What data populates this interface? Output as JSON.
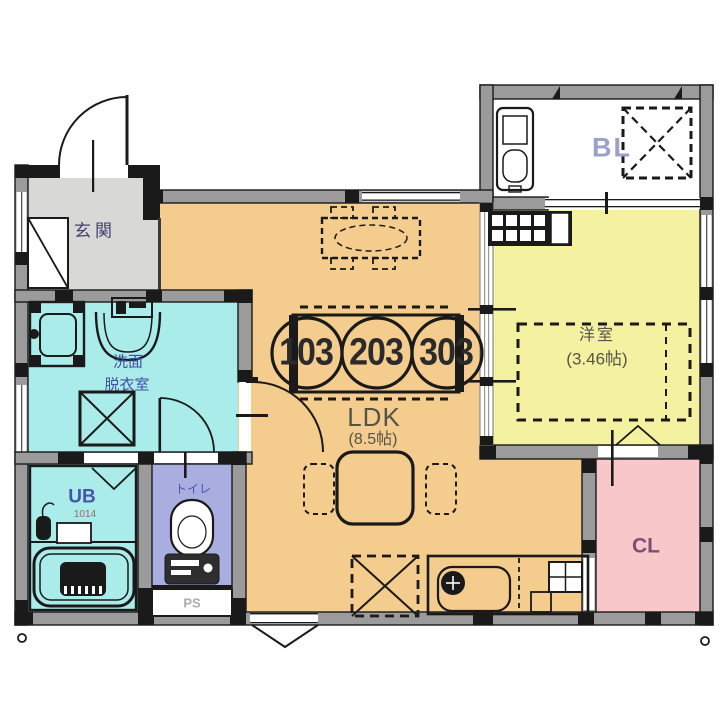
{
  "plan_title": "1LDK apartment floor plan",
  "unit_numbers": [
    "103",
    "203",
    "303"
  ],
  "rooms": {
    "entrance": {
      "label": "玄関"
    },
    "ldk": {
      "label": "LDK",
      "area": "(8.5帖)"
    },
    "western_room": {
      "label": "洋室",
      "area": "(3.46帖)"
    },
    "balcony": {
      "label": "BL"
    },
    "closet": {
      "label": "CL"
    },
    "washroom": {
      "line1": "洗面",
      "line2": "脱衣室"
    },
    "toilet": {
      "label": "トイレ"
    },
    "unit_bath": {
      "label": "UB",
      "size": "1014"
    },
    "pipe_space": {
      "label": "PS"
    }
  },
  "colors": {
    "ldk": "#F3CC8E",
    "western_room": "#F4F1A1",
    "wet_area_cyan": "#AAECE9",
    "toilet_lavender": "#A9ADE0",
    "closet_pink": "#F8C7CA",
    "entrance_gray": "#D8D8D6",
    "balcony_white": "#FFFFFF",
    "wall_fill": "#9B9B9B",
    "wall_line": "#1A1A1A",
    "label_blue": "#4050A0",
    "label_dark": "#55544A",
    "label_bl": "#98A2C8",
    "label_cl": "#7E4E78",
    "label_entrance": "#42426A",
    "label_ub_size": "#996A6A",
    "label_ps": "#A8ADB5",
    "unit_number": "#2B2B2B"
  },
  "icons": {
    "entrance_door": "quarter-arc-door",
    "shoe_cabinet": "diagonal-box",
    "washing_machine": "corner-pad-box",
    "vanity_sink": "bowl-with-faucet",
    "washer_pan": "x-cross-box",
    "toilet_fixture": "tank-and-bowl",
    "bath_tub": "rounded-tub",
    "shower_head": "shower-head",
    "dining_table": "dashed-table-with-chairs",
    "living_table": "rounded-table-two-chairs",
    "kitchen_sink": "d-sink-with-faucet",
    "gas_stove": "grid-box",
    "refrigerator_space": "dashed-x-box",
    "ac_outdoor_unit_space": "dashed-x-box",
    "balcony_washer_space": "machine-box",
    "bed_space": "dashed-rect",
    "counter_shelf": "slotted-bar",
    "closet_folding_door": "chevron-mark",
    "unit_number_stamp": "three-circles-over-plate"
  }
}
